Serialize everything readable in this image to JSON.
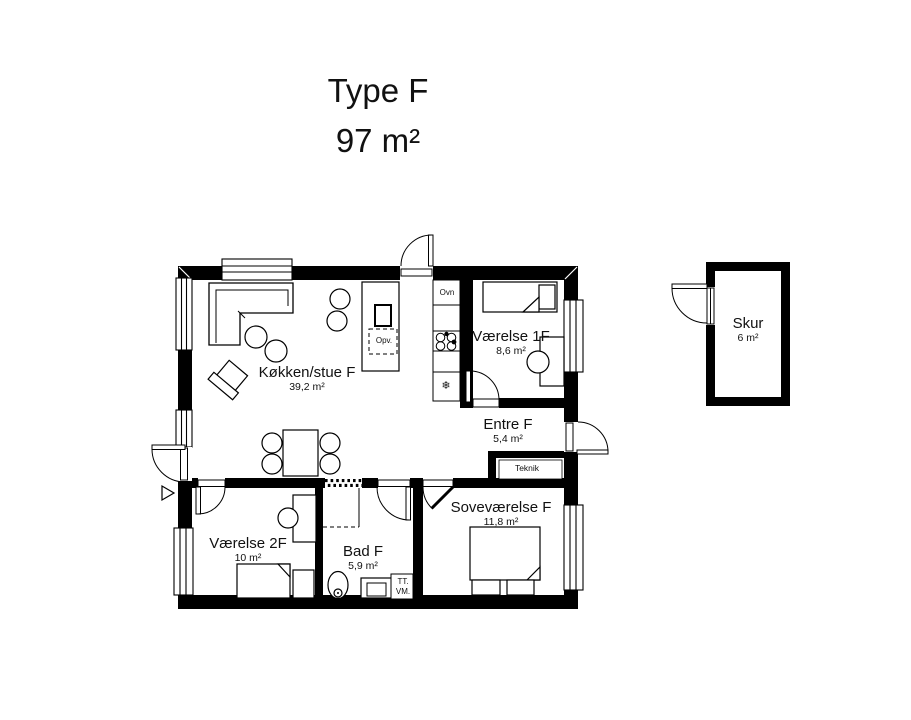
{
  "title": {
    "line1": "Type F",
    "line2": "97 m²"
  },
  "rooms": {
    "kokken": {
      "name": "Køkken/stue F",
      "area": "39,2 m²"
    },
    "vaerelse1": {
      "name": "Værelse 1F",
      "area": "8,6 m²"
    },
    "entre": {
      "name": "Entre F",
      "area": "5,4 m²"
    },
    "teknik": {
      "name": "Teknik"
    },
    "sovevaerelse": {
      "name": "Soveværelse F",
      "area": "11,8 m²"
    },
    "vaerelse2": {
      "name": "Værelse 2F",
      "area": "10 m²"
    },
    "bad": {
      "name": "Bad F",
      "area": "5,9 m²"
    },
    "skur": {
      "name": "Skur",
      "area": "6 m²"
    }
  },
  "labels": {
    "oven": "Ovn",
    "dishwasher": "Opv.",
    "dryer": "TT.",
    "washer": "VM."
  },
  "icons": {
    "freezer": "❄"
  },
  "colors": {
    "wall": "#000000",
    "text": "#111111",
    "background": "#ffffff"
  }
}
